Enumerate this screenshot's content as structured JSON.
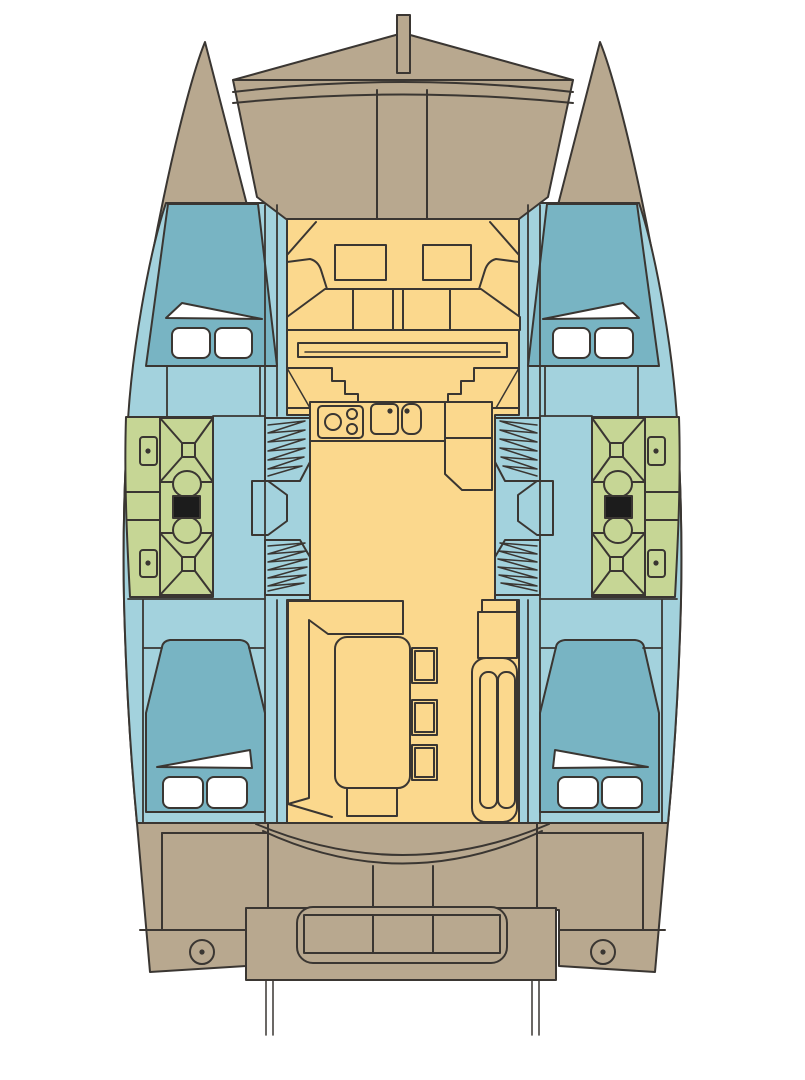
{
  "title": "Catamaran interior deck plan",
  "colors": {
    "background": "#ffffff",
    "outline": "#3a3632",
    "hull": "#b8a88f",
    "cabin": "#a3d2dd",
    "bed": "#78b4c3",
    "saloon": "#fbd88d",
    "bathroom": "#c6d695",
    "linens": "#ffffff",
    "toilet_seat": "#1c1c1c"
  },
  "vessel": {
    "type": "catamaran",
    "view": "top-down interior layout, bow at top",
    "cabins": 4,
    "bathrooms": 2,
    "galley_burners": 3,
    "galley_sinks": 2,
    "dinette_stools": 3,
    "stern_winches": 2
  },
  "regions": {
    "bow": [
      "bowsprit",
      "bow peak",
      "crossbeam / trampoline arcs",
      "foredeck panels"
    ],
    "port_hull": [
      "forward double berth with pillows",
      "bathroom: shower, sink, toilet",
      "companionway steps",
      "aft double berth with pillows",
      "stern deck with winch"
    ],
    "starboard_hull": [
      "forward double berth with pillows",
      "bathroom: shower, sink, toilet",
      "companionway steps",
      "aft double berth with pillows",
      "stern deck with winch"
    ],
    "saloon": [
      "forward lounge with two tables and wrap bench",
      "galley: 3-burner stove, double sink, counters",
      "chart/nav counter",
      "dinette: L-sofa, table, three stools",
      "starboard settee with two cushions",
      "aft cockpit curved seat",
      "transom bench (3 sections)",
      "swim platform",
      "dinghy davits"
    ]
  }
}
